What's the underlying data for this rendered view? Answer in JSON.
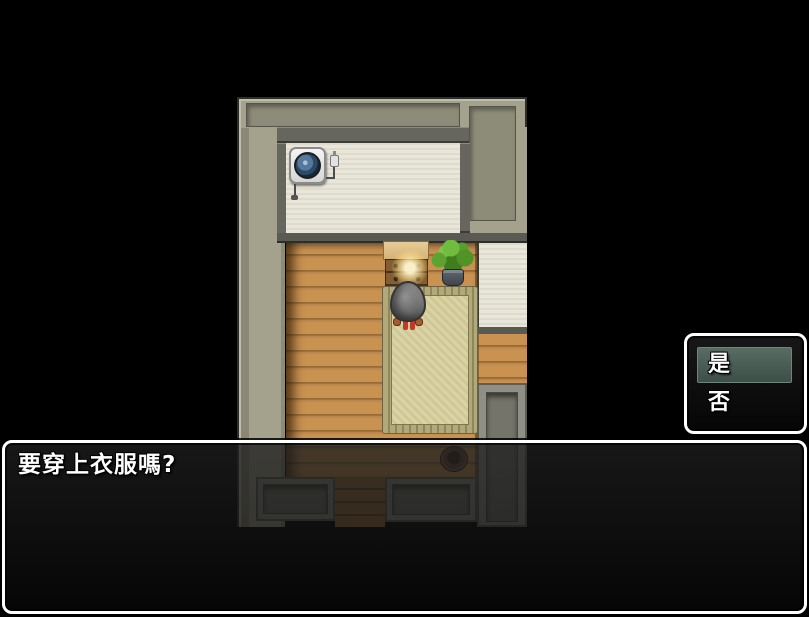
{
  "window": {
    "width": 809,
    "height": 617
  },
  "dialog": {
    "text": "要穿上衣服嗎?"
  },
  "choice_menu": {
    "options": [
      {
        "label": "是",
        "selected": true
      },
      {
        "label": "否",
        "selected": false
      }
    ]
  },
  "room": {
    "objects": [
      "ventilation-fan-unit",
      "power-plug",
      "dresser",
      "glowing-orb",
      "potted-plant",
      "tatami-mat",
      "player-character-gray-blob",
      "wooden-bucket",
      "wood-plank-floor",
      "south-exit-passage",
      "east-passage"
    ]
  },
  "colors": {
    "background": "#000000",
    "window_border": "#ffffff",
    "window_fill": "rgba(16,16,16,0.75)",
    "selection_highlight": "#46594f",
    "floor_plank": "#c08a4a",
    "tatami": "#d6d0a2",
    "wall_beige": "#a4a18d",
    "wall_cream": "#e9e6da",
    "text": "#ffffff"
  }
}
